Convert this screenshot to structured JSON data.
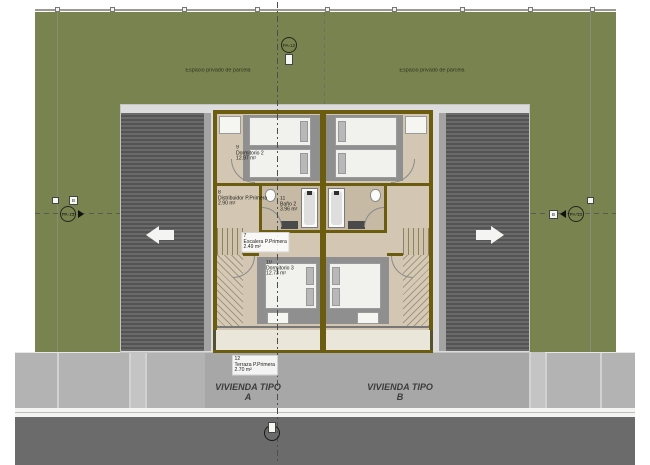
{
  "parcel": {
    "left_label": "Espacio privado de parcela",
    "right_label": "Espacio privado de parcela"
  },
  "rooms": [
    {
      "num": "9",
      "name": "Dormitorio 2",
      "area": "12.97 m²"
    },
    {
      "num": "8",
      "name": "Distribuidor P.Primera",
      "area": "2.90 m²"
    },
    {
      "num": "11",
      "name": "Baño 2",
      "area": "3.96 m²"
    },
    {
      "num": "7",
      "name": "Escalera P.Primera",
      "area": "2.49 m²"
    },
    {
      "num": "10",
      "name": "Dormitorio 3",
      "area": "12.73 m²"
    },
    {
      "num": "12",
      "name": "Terraza P.Primera",
      "area": "2.70 m²"
    }
  ],
  "houses": {
    "a": {
      "line1": "VIVIENDA TIPO",
      "line2": "A"
    },
    "b": {
      "line1": "VIVIENDA TIPO",
      "line2": "B"
    }
  },
  "markers": {
    "top": "PA-12",
    "left": "PA-13",
    "right": "PA-13",
    "grid_left": "B",
    "grid_right": "B"
  },
  "colors": {
    "parcel_green": "#79834f",
    "roof_gray": "#5f5f5f",
    "floor_tan": "#d3c7b3",
    "wall_olive": "#6b5c10",
    "terrace_cream": "#eae6da",
    "sidewalk_gray": "#b3b3b3",
    "road_gray": "#6b6b6b"
  }
}
